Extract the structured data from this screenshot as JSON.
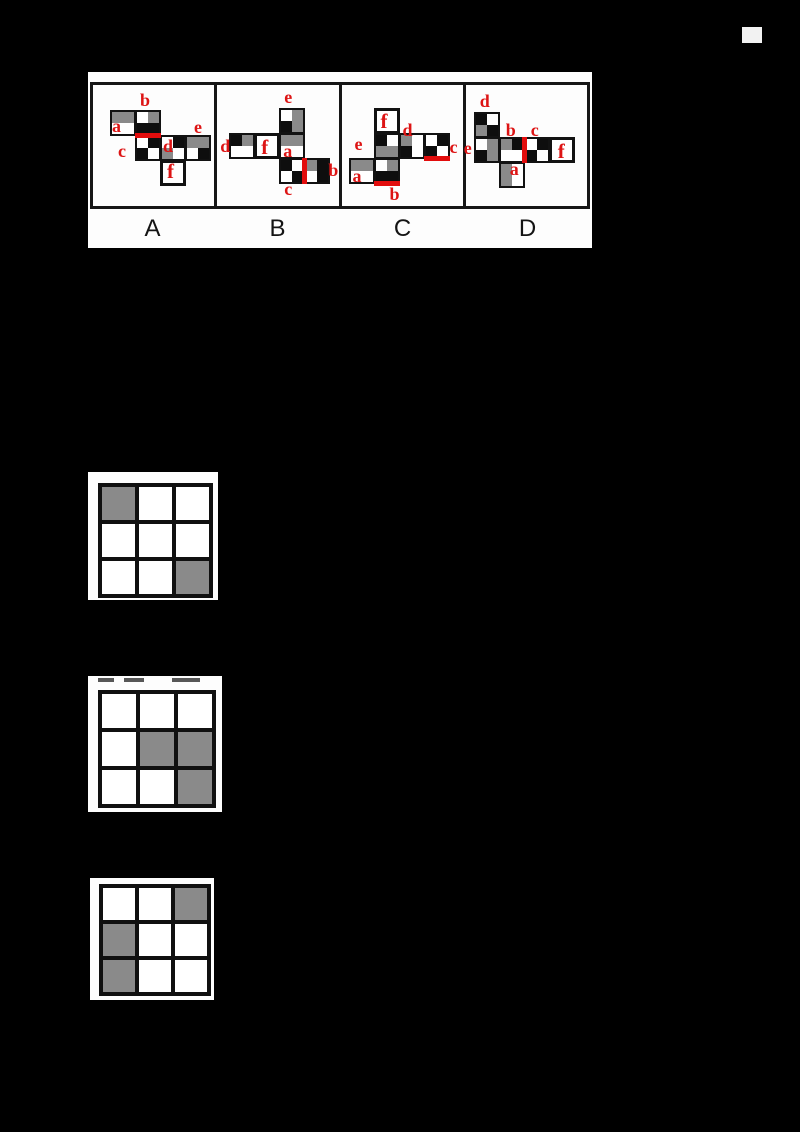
{
  "canvas": {
    "width": 800,
    "height": 1132,
    "background": "#000000"
  },
  "figure_type": "cube-net multiple-choice question with shading grids",
  "palette": {
    "quad_black": "#0e0e0e",
    "quad_gray": "#8a8a8a",
    "quad_white": "#ffffff",
    "accent_red": "#e20d0d",
    "card_white": "#fdfdfd",
    "letter_black": "#141414"
  },
  "options_panel": {
    "position": {
      "left": 88,
      "top": 72,
      "width": 504,
      "height": 176
    },
    "face_unit_px": 25,
    "options": [
      {
        "label": "A",
        "net": {
          "offset": {
            "x": 17,
            "y": 25
          },
          "faces": [
            {
              "col": 0,
              "row": 0,
              "quads": [
                "gray",
                "gray",
                "white",
                "white"
              ]
            },
            {
              "col": 1,
              "row": 0,
              "quads": [
                "white",
                "gray",
                "black",
                "black"
              ],
              "red_edge": "bottom"
            },
            {
              "col": 1,
              "row": 1,
              "quads": [
                "white",
                "black",
                "black",
                "white"
              ]
            },
            {
              "col": 2,
              "row": 1,
              "quads": [
                "white",
                "black",
                "gray",
                "white"
              ]
            },
            {
              "col": 3,
              "row": 1,
              "quads": [
                "gray",
                "gray",
                "white",
                "black"
              ]
            },
            {
              "col": 2,
              "row": 2,
              "plain": true
            }
          ],
          "labels": [
            {
              "text": "b",
              "x": 30,
              "y": -19
            },
            {
              "text": "a",
              "x": 2,
              "y": 7
            },
            {
              "text": "e",
              "x": 84,
              "y": 8
            },
            {
              "text": "c",
              "x": 8,
              "y": 32
            },
            {
              "text": "d",
              "x": 53,
              "y": 27
            },
            {
              "text": "f",
              "x": 57,
              "y": 51,
              "size": 21
            }
          ]
        }
      },
      {
        "label": "B",
        "net": {
          "offset": {
            "x": 12,
            "y": 23
          },
          "faces": [
            {
              "col": 2,
              "row": 0,
              "quads": [
                "white",
                "gray",
                "black",
                "gray"
              ]
            },
            {
              "col": 0,
              "row": 1,
              "quads": [
                "black",
                "gray",
                "white",
                "white"
              ]
            },
            {
              "col": 1,
              "row": 1,
              "plain": true
            },
            {
              "col": 2,
              "row": 1,
              "quads": [
                "gray",
                "gray",
                "white",
                "white"
              ]
            },
            {
              "col": 2,
              "row": 2,
              "quads": [
                "black",
                "white",
                "white",
                "black"
              ],
              "red_edge": "right"
            },
            {
              "col": 3,
              "row": 2,
              "quads": [
                "gray",
                "black",
                "white",
                "black"
              ]
            }
          ],
          "labels": [
            {
              "text": "e",
              "x": 55,
              "y": -20
            },
            {
              "text": "d",
              "x": -9,
              "y": 29
            },
            {
              "text": "f",
              "x": 32,
              "y": 29,
              "size": 21
            },
            {
              "text": "a",
              "x": 54,
              "y": 34
            },
            {
              "text": "c",
              "x": 55,
              "y": 72
            },
            {
              "text": "b",
              "x": 99,
              "y": 53
            }
          ]
        }
      },
      {
        "label": "C",
        "net": {
          "offset": {
            "x": 7,
            "y": 23
          },
          "faces": [
            {
              "col": 1,
              "row": 0,
              "plain": true
            },
            {
              "col": 1,
              "row": 1,
              "quads": [
                "black",
                "white",
                "gray",
                "gray"
              ]
            },
            {
              "col": 2,
              "row": 1,
              "quads": [
                "gray",
                "white",
                "black",
                "white"
              ]
            },
            {
              "col": 3,
              "row": 1,
              "quads": [
                "white",
                "black",
                "black",
                "white"
              ],
              "red_edge": "bottom"
            },
            {
              "col": 0,
              "row": 2,
              "quads": [
                "gray",
                "gray",
                "white",
                "white"
              ]
            },
            {
              "col": 1,
              "row": 2,
              "quads": [
                "white",
                "gray",
                "black",
                "black"
              ],
              "red_edge": "bottom"
            }
          ],
          "labels": [
            {
              "text": "f",
              "x": 32,
              "y": 3,
              "size": 21
            },
            {
              "text": "d",
              "x": 54,
              "y": 13
            },
            {
              "text": "e",
              "x": 6,
              "y": 27
            },
            {
              "text": "c",
              "x": 101,
              "y": 30
            },
            {
              "text": "a",
              "x": 4,
              "y": 59
            },
            {
              "text": "b",
              "x": 41,
              "y": 77
            }
          ]
        }
      },
      {
        "label": "D",
        "net": {
          "offset": {
            "x": 8,
            "y": 27
          },
          "faces": [
            {
              "col": 0,
              "row": 0,
              "quads": [
                "black",
                "white",
                "gray",
                "black"
              ]
            },
            {
              "col": 0,
              "row": 1,
              "quads": [
                "white",
                "gray",
                "black",
                "gray"
              ]
            },
            {
              "col": 1,
              "row": 1,
              "quads": [
                "gray",
                "black",
                "white",
                "white"
              ]
            },
            {
              "col": 2,
              "row": 1,
              "quads": [
                "white",
                "black",
                "black",
                "white"
              ],
              "red_edge": "left"
            },
            {
              "col": 3,
              "row": 1,
              "plain": true
            },
            {
              "col": 1,
              "row": 2,
              "quads": [
                "gray",
                "white",
                "gray",
                "white"
              ]
            }
          ],
          "labels": [
            {
              "text": "d",
              "x": 6,
              "y": -20
            },
            {
              "text": "e",
              "x": -10,
              "y": 27
            },
            {
              "text": "b",
              "x": 32,
              "y": 9
            },
            {
              "text": "c",
              "x": 57,
              "y": 9
            },
            {
              "text": "f",
              "x": 84,
              "y": 29,
              "size": 21
            },
            {
              "text": "a",
              "x": 36,
              "y": 48
            }
          ]
        }
      }
    ]
  },
  "shading_grids": [
    {
      "name": "grid-1",
      "position": {
        "left": 88,
        "top": 472,
        "width": 130,
        "height": 128
      },
      "grid": {
        "left": 10,
        "top": 11,
        "cell": 33,
        "line": 4
      },
      "cells": [
        [
          1,
          0,
          0
        ],
        [
          0,
          0,
          0
        ],
        [
          0,
          0,
          1
        ]
      ],
      "legend": "1 = gray shaded cell, 0 = white cell"
    },
    {
      "name": "grid-2",
      "position": {
        "left": 88,
        "top": 676,
        "width": 134,
        "height": 136
      },
      "grid": {
        "left": 10,
        "top": 14,
        "cell": 34,
        "line": 4
      },
      "cells": [
        [
          0,
          0,
          0
        ],
        [
          0,
          1,
          1
        ],
        [
          0,
          0,
          1
        ]
      ],
      "smudges": [
        {
          "x": 10,
          "w": 16
        },
        {
          "x": 36,
          "w": 20
        },
        {
          "x": 84,
          "w": 28
        }
      ]
    },
    {
      "name": "grid-3",
      "position": {
        "left": 90,
        "top": 878,
        "width": 124,
        "height": 122
      },
      "grid": {
        "left": 9,
        "top": 6,
        "cell": 32,
        "line": 4
      },
      "cells": [
        [
          0,
          0,
          1
        ],
        [
          1,
          0,
          0
        ],
        [
          1,
          0,
          0
        ]
      ]
    }
  ],
  "artifacts": {
    "fleck": {
      "left": 742,
      "top": 27,
      "width": 20,
      "height": 16
    }
  }
}
